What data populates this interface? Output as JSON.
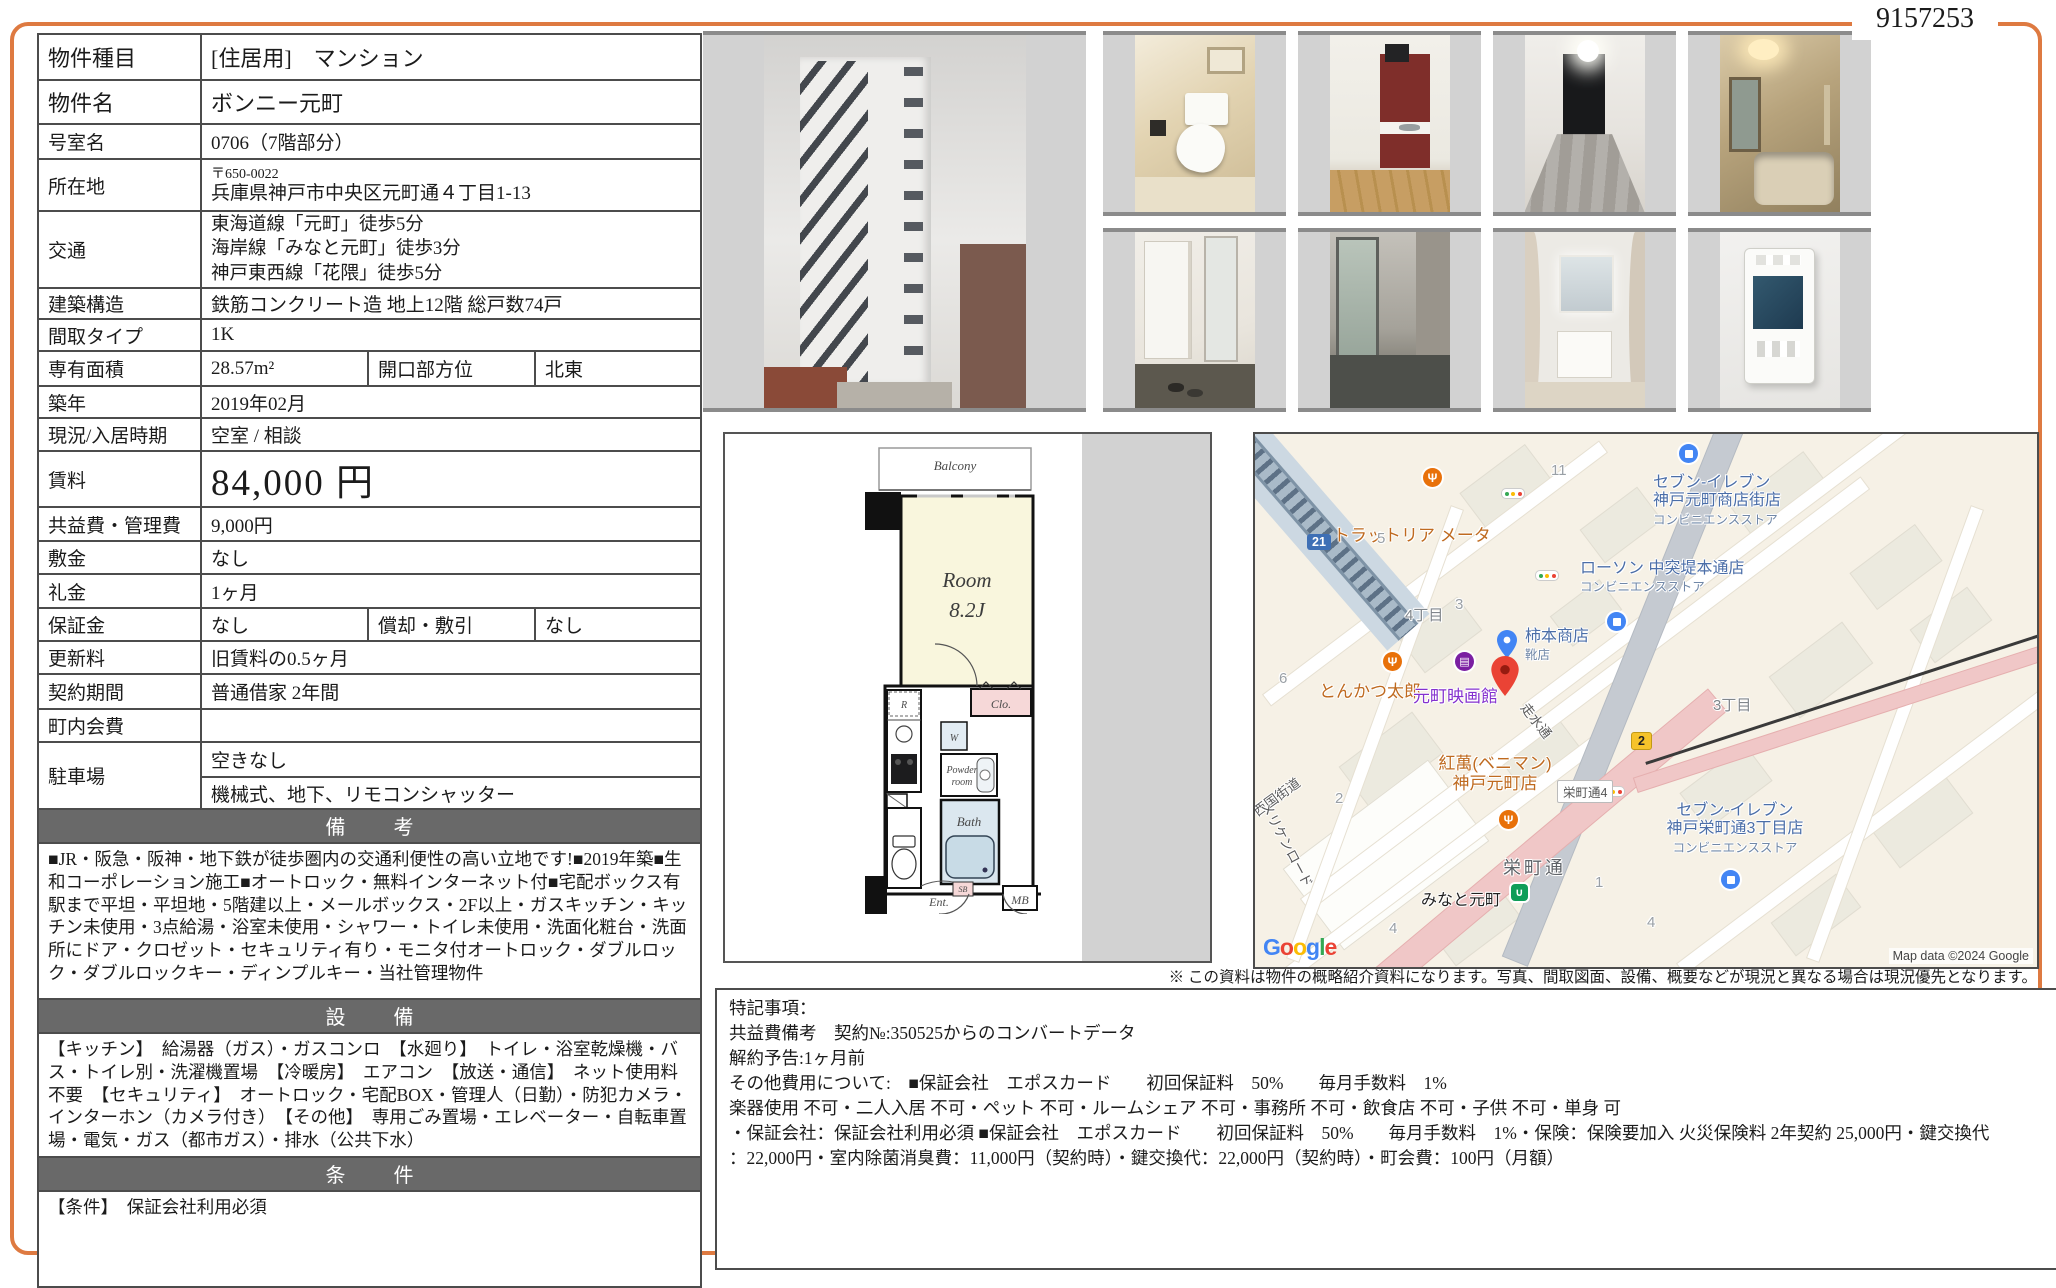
{
  "page": {
    "id": "9157253",
    "disclaimer": "※ この資料は物件の概略紹介資料になります。写真、間取図面、設備、概要などが現況と異なる場合は現況優先となります。"
  },
  "table": {
    "rows": {
      "type": {
        "label": "物件種目",
        "value": "[住居用]　マンション"
      },
      "name": {
        "label": "物件名",
        "value": "ボンニー元町"
      },
      "room_no": {
        "label": "号室名",
        "value": "0706（7階部分）"
      },
      "address": {
        "label": "所在地",
        "postal": "〒650-0022",
        "value": "兵庫県神戸市中央区元町通４丁目1-13"
      },
      "transport": {
        "label": "交通",
        "line1": "東海道線「元町」徒歩5分",
        "line2": "海岸線「みなと元町」徒歩3分",
        "line3": "神戸東西線「花隈」徒歩5分"
      },
      "structure": {
        "label": "建築構造",
        "value": "鉄筋コンクリート造 地上12階 総戸数74戸"
      },
      "layout": {
        "label": "間取タイプ",
        "value": "1K"
      },
      "area": {
        "label": "専有面積",
        "value": "28.57m²",
        "label2": "開口部方位",
        "value2": "北東"
      },
      "built": {
        "label": "築年",
        "value": "2019年02月"
      },
      "status": {
        "label": "現況/入居時期",
        "value": "空室 /  相談"
      },
      "rent": {
        "label": "賃料",
        "value": "84,000 円"
      },
      "fee": {
        "label": "共益費・管理費",
        "value": "9,000円"
      },
      "deposit": {
        "label": "敷金",
        "value": "なし"
      },
      "key_money": {
        "label": "礼金",
        "value": "1ヶ月"
      },
      "guarantee": {
        "label": "保証金",
        "value": "なし",
        "label2": "償却・敷引",
        "value2": "なし"
      },
      "renewal": {
        "label": "更新料",
        "value": "旧賃料の0.5ヶ月"
      },
      "contract": {
        "label": "契約期間",
        "value": "普通借家 2年間"
      },
      "town_fee": {
        "label": "町内会費",
        "value": ""
      },
      "parking": {
        "label": "駐車場",
        "value1": "空きなし",
        "value2": "機械式、地下、リモコンシャッター"
      }
    },
    "sections": {
      "remarks_header": "備　考",
      "remarks1": "■JR・阪急・阪神・地下鉄が徒歩圏内の交通利便性の高い立地です!■2019年築■生和コーポレーション施工■オートロック・無料インターネット付■宅配ボックス有",
      "remarks2": "駅まで平坦・平坦地・5階建以上・メールボックス・2F以上・ガスキッチン・キッチン未使用・3点給湯・浴室未使用・シャワー・トイレ未使用・洗面化粧台・洗面所にドア・クロゼット・セキュリティ有り・モニタ付オートロック・ダブルロック・ダブルロックキー・ディンプルキー・当社管理物件",
      "equipment_header": "設　備",
      "equipment": "【キッチン】　給湯器（ガス）・ガスコンロ　【水廻り】　トイレ・浴室乾燥機・バス・トイレ別・洗濯機置場　【冷暖房】　エアコン　【放送・通信】　ネット使用料不要　【セキュリティ】　オートロック・宅配BOX・管理人（日勤）・防犯カメラ・インターホン（カメラ付き）　【その他】　専用ごみ置場・エレベーター・自転車置場・電気・ガス（都市ガス）・排水（公共下水）",
      "conditions_header": "条　件",
      "conditions": "【条件】　保証会社利用必須"
    }
  },
  "notes": {
    "title": "特記事項：",
    "line1": "共益費備考　契約№:350525からのコンバートデータ",
    "line2": "解約予告:1ヶ月前",
    "line3": "その他費用について:　■保証会社　エポスカード　　初回保証料　50%　　毎月手数料　1%",
    "line4": "楽器使用 不可・二人入居 不可・ペット 不可・ルームシェア 不可・事務所 不可・飲食店 不可・子供 不可・単身 可",
    "line5": "・保証会社：保証会社利用必須 ■保証会社　エポスカード　　初回保証料　50%　　毎月手数料　1%・保険：保険要加入 火災保険料 2年契約 25,000円・鍵交換代",
    "line6": "：22,000円・室内除菌消臭費：11,000円（契約時）・鍵交換代：22,000円（契約時）・町会費：100円（月額）"
  },
  "floorplan": {
    "balcony": "Balcony",
    "room": "Room",
    "room_size": "8.2J",
    "fridge": "R",
    "closet": "Clo.",
    "washer": "W",
    "powder1": "Powder",
    "powder2": "room",
    "bath": "Bath",
    "entrance": "Ent.",
    "shoebox": "SB",
    "meterbox": "MB"
  },
  "map": {
    "trattoria": "トラットリア メータ",
    "badge21": "21",
    "badge2": "2",
    "n5": "5",
    "n11": "11",
    "n6": "6",
    "n3": "3",
    "n2": "2",
    "n1": "1",
    "n4a": "4",
    "n4b": "4",
    "chome4": "4丁目",
    "chome3": "3丁目",
    "seven1a": "セブン-イレブン",
    "seven1b": "神戸元町商店街店",
    "seven1c": "コンビニエンスストア",
    "lawson1": "ローソン 中突堤本通店",
    "lawson2": "コンビニエンスストア",
    "kakimoto1": "柿本商店",
    "kakimoto2": "靴店",
    "tonkatsu": "とんかつ太郎",
    "cinema": "元町映画館",
    "beniman1": "紅萬(ベニマン)",
    "beniman2": "神戸元町店",
    "sakaemachi4": "栄町通4",
    "hashirimizu": "走水通",
    "saigoku": "西国街道",
    "meriken": "メリケンロード",
    "sakaemachi": "栄町通",
    "minato": "みなと元町",
    "seven2a": "セブン-イレブン",
    "seven2b": "神戸栄町通3丁目店",
    "seven2c": "コンビニエンスストア",
    "google_l1": "G",
    "google_l2": "o",
    "google_l3": "o",
    "google_l4": "g",
    "google_l5": "l",
    "google_l6": "e",
    "attribution": "Map data ©2024 Google"
  },
  "colors": {
    "accent_orange": "#de7a41",
    "header_gray": "#696969",
    "map_pin_red": "#ea4335",
    "map_pin_blue": "#4285f4"
  }
}
